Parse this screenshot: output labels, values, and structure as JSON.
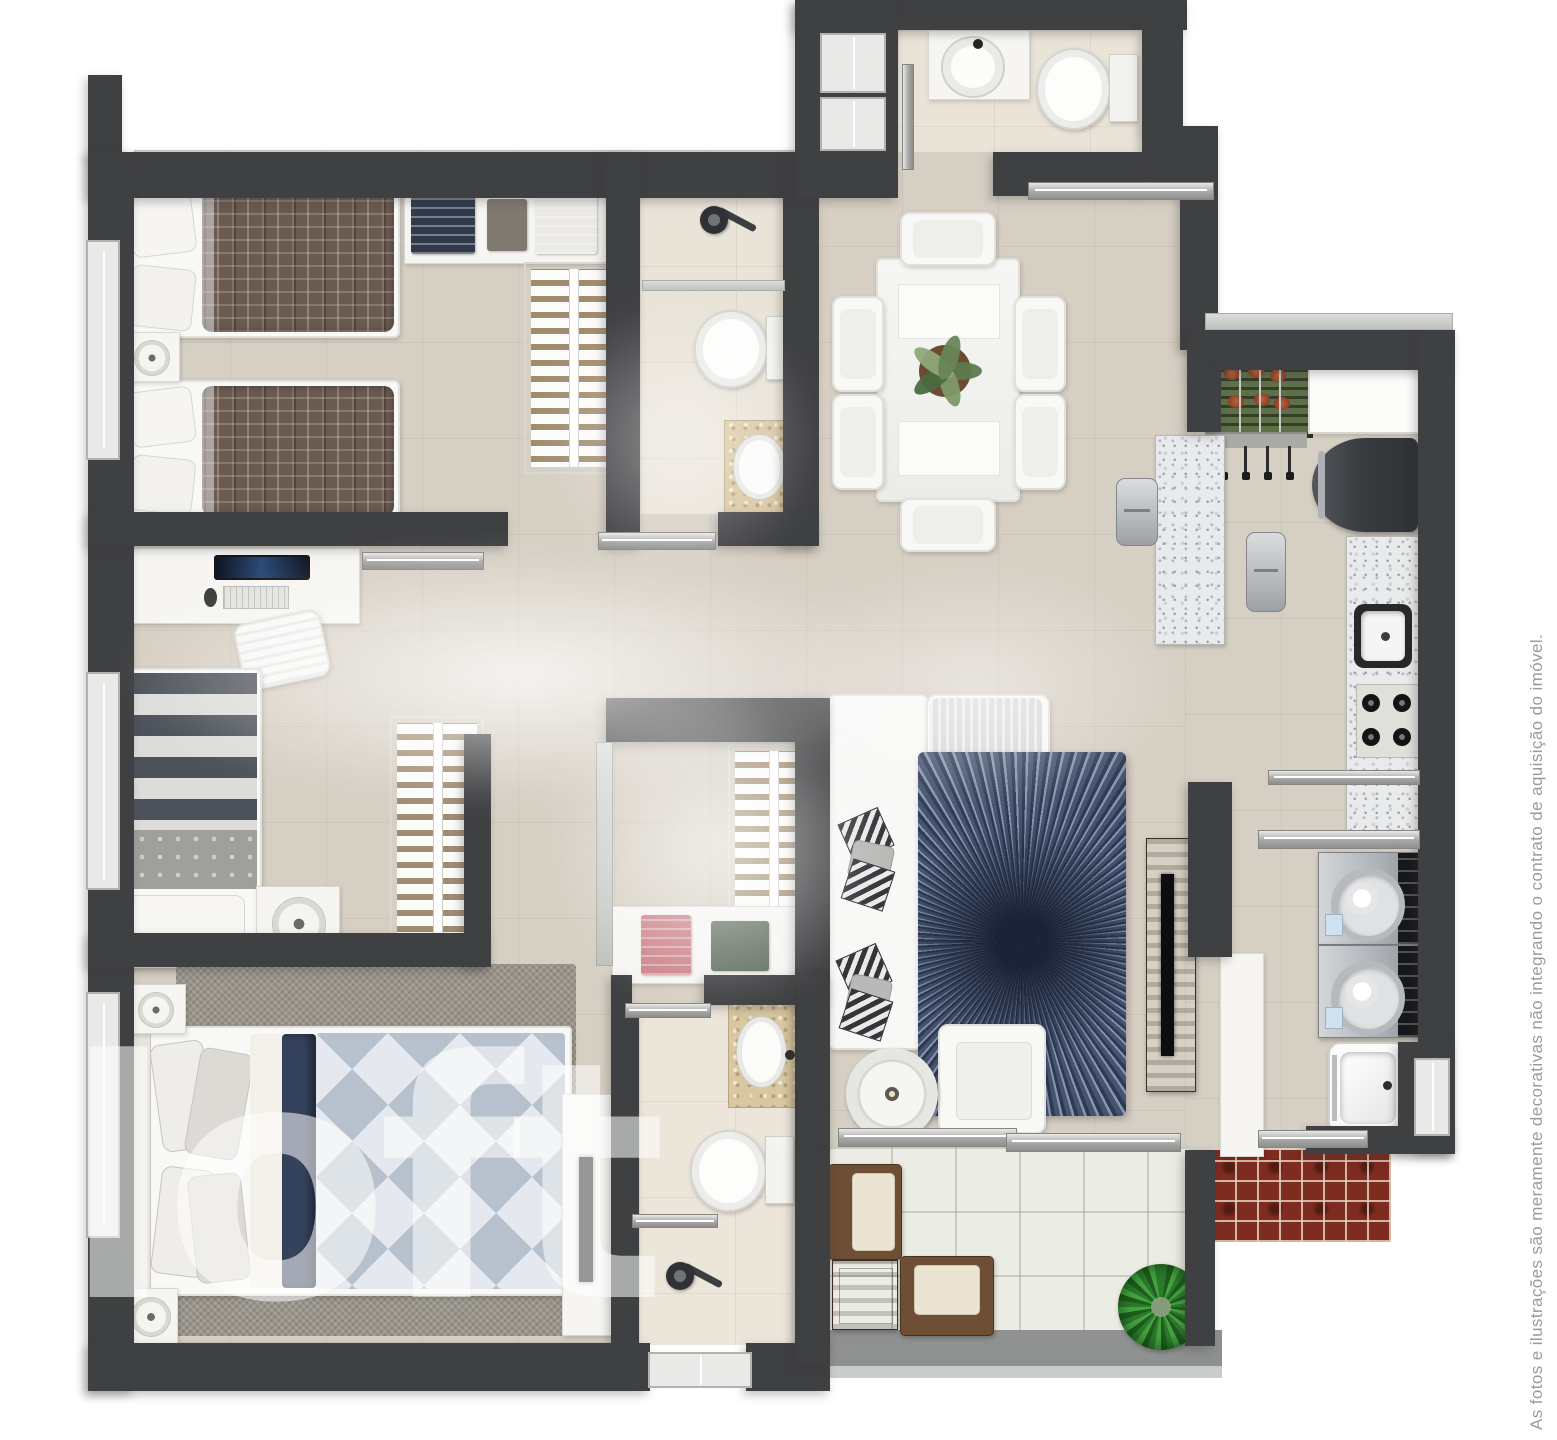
{
  "watermark": {
    "text": "loft"
  },
  "disclaimer": {
    "text": "As fotos e ilustrações são meramente decorativas não integrando o contrato de aquisição do imóvel."
  },
  "palette": {
    "wall": "#3f4042",
    "floor": "#d6cfc3",
    "bath_floor": "#e9e3d8",
    "balcony_tile": "#ebece3",
    "brick": "#7e2b20",
    "rug_blue": "#2e3a54",
    "rug_grey": "#9a958b",
    "plaid_brown": "#6a5a50",
    "navy_fold": "#35425c",
    "bbq_green": "#5e7048",
    "wood": "#6b4a33",
    "silver": "#a7a7a5",
    "granite": "#e9eaeb",
    "marble": "#d8c7a0",
    "watermark_white": "rgba(255,255,255,0.55)",
    "disclaimer_grey": "#9b9b9b"
  },
  "canvas": {
    "width": 1557,
    "height": 1440
  },
  "floorplan": {
    "floors": [
      {
        "name": "main-floor-left",
        "x": 134,
        "y": 150,
        "w": 1051,
        "h": 1000,
        "fill": "base"
      },
      {
        "name": "kitchen-laundry-floor",
        "x": 1185,
        "y": 330,
        "w": 233,
        "h": 822,
        "fill": "base"
      },
      {
        "name": "master-floor-strip",
        "x": 134,
        "y": 1150,
        "w": 661,
        "h": 195,
        "fill": "base"
      },
      {
        "name": "lavabo-floor",
        "x": 898,
        "y": 30,
        "w": 246,
        "h": 122,
        "fill": "cream"
      },
      {
        "name": "bathroom1-floor",
        "x": 640,
        "y": 170,
        "w": 143,
        "h": 344,
        "fill": "cream"
      },
      {
        "name": "master-bath-floor",
        "x": 639,
        "y": 1005,
        "w": 159,
        "h": 340,
        "fill": "cream2"
      },
      {
        "name": "balcony-floor",
        "x": 825,
        "y": 1145,
        "w": 362,
        "h": 190,
        "fill": "btile"
      },
      {
        "name": "service-brick-floor",
        "x": 1213,
        "y": 1150,
        "w": 178,
        "h": 92,
        "fill": "brick"
      },
      {
        "name": "balcony-railing",
        "x": 818,
        "y": 1330,
        "w": 404,
        "h": 36,
        "fill": "railband"
      },
      {
        "name": "balcony-railing-edge",
        "x": 818,
        "y": 1366,
        "w": 404,
        "h": 12,
        "fill": "railband-light"
      }
    ],
    "walls": [
      {
        "name": "corner-tab",
        "x": 88,
        "y": 75,
        "w": 34,
        "h": 82
      },
      {
        "name": "top-wall",
        "x": 88,
        "y": 152,
        "w": 710,
        "h": 46
      },
      {
        "name": "left-outer-wall",
        "x": 88,
        "y": 152,
        "w": 46,
        "h": 1239
      },
      {
        "name": "bedroom1-bottom-wall",
        "x": 88,
        "y": 512,
        "w": 420,
        "h": 34
      },
      {
        "name": "bedroom1-bath-wall",
        "x": 606,
        "y": 152,
        "w": 34,
        "h": 394
      },
      {
        "name": "bathroom1-right-wall",
        "x": 783,
        "y": 152,
        "w": 36,
        "h": 394
      },
      {
        "name": "bathroom1-bottom-wall",
        "x": 718,
        "y": 512,
        "w": 101,
        "h": 34
      },
      {
        "name": "lavabo-top-wall",
        "x": 795,
        "y": 0,
        "w": 392,
        "h": 30
      },
      {
        "name": "lavabo-left-block",
        "x": 795,
        "y": 0,
        "w": 103,
        "h": 198
      },
      {
        "name": "lavabo-right-wall",
        "x": 1142,
        "y": 28,
        "w": 41,
        "h": 102
      },
      {
        "name": "lavabo-corner-block",
        "x": 1142,
        "y": 126,
        "w": 76,
        "h": 70
      },
      {
        "name": "below-lavabo-wall",
        "x": 993,
        "y": 152,
        "w": 150,
        "h": 44
      },
      {
        "name": "dining-right-wall",
        "x": 1180,
        "y": 192,
        "w": 38,
        "h": 158
      },
      {
        "name": "kitchen-top-wall",
        "x": 1187,
        "y": 330,
        "w": 266,
        "h": 40
      },
      {
        "name": "bbq-left-wall",
        "x": 1187,
        "y": 368,
        "w": 34,
        "h": 64
      },
      {
        "name": "right-outer-wall",
        "x": 1418,
        "y": 330,
        "w": 37,
        "h": 822
      },
      {
        "name": "laundry-corner-block",
        "x": 1398,
        "y": 1042,
        "w": 57,
        "h": 110
      },
      {
        "name": "below-laundry-wall",
        "x": 1306,
        "y": 1126,
        "w": 149,
        "h": 28
      },
      {
        "name": "living-kitchen-wall",
        "x": 1188,
        "y": 782,
        "w": 44,
        "h": 175
      },
      {
        "name": "living-left-wall",
        "x": 795,
        "y": 698,
        "w": 35,
        "h": 452
      },
      {
        "name": "closet-top-wall",
        "x": 606,
        "y": 698,
        "w": 224,
        "h": 44
      },
      {
        "name": "bedroom2-right-wall",
        "x": 464,
        "y": 734,
        "w": 27,
        "h": 233
      },
      {
        "name": "bedroom2-bottom-wall",
        "x": 88,
        "y": 933,
        "w": 403,
        "h": 34
      },
      {
        "name": "closet-bottom-wall-left",
        "x": 611,
        "y": 975,
        "w": 21,
        "h": 30
      },
      {
        "name": "closet-bottom-wall-right",
        "x": 704,
        "y": 975,
        "w": 126,
        "h": 30
      },
      {
        "name": "master-bath-left-wall",
        "x": 611,
        "y": 1005,
        "w": 28,
        "h": 340
      },
      {
        "name": "master-bath-right-wall",
        "x": 798,
        "y": 975,
        "w": 32,
        "h": 372
      },
      {
        "name": "bottom-outer-wall-left",
        "x": 88,
        "y": 1343,
        "w": 562,
        "h": 48
      },
      {
        "name": "bottom-outer-wall-right",
        "x": 746,
        "y": 1343,
        "w": 84,
        "h": 48
      },
      {
        "name": "balcony-right-wall",
        "x": 1185,
        "y": 1150,
        "w": 30,
        "h": 196
      },
      {
        "name": "balcony-left-wall",
        "x": 795,
        "y": 1150,
        "w": 33,
        "h": 215
      }
    ],
    "windows": [
      {
        "name": "window-bedroom1",
        "x": 86,
        "y": 240,
        "w": 30,
        "h": 216
      },
      {
        "name": "window-bedroom2",
        "x": 86,
        "y": 672,
        "w": 30,
        "h": 214
      },
      {
        "name": "window-master",
        "x": 86,
        "y": 992,
        "w": 30,
        "h": 242
      },
      {
        "name": "window-lavabo-1",
        "x": 820,
        "y": 33,
        "w": 62,
        "h": 56
      },
      {
        "name": "window-lavabo-2",
        "x": 820,
        "y": 97,
        "w": 62,
        "h": 50
      },
      {
        "name": "window-laundry",
        "x": 1414,
        "y": 1058,
        "w": 32,
        "h": 74
      },
      {
        "name": "window-master-bath",
        "x": 648,
        "y": 1352,
        "w": 100,
        "h": 32
      }
    ],
    "rails": [
      {
        "name": "dining-partition-rail",
        "x": 1028,
        "y": 182,
        "w": 184,
        "h": 16
      },
      {
        "name": "bedroom2-door-rail",
        "x": 362,
        "y": 552,
        "w": 120,
        "h": 16
      },
      {
        "name": "bathroom1-door-rail",
        "x": 598,
        "y": 532,
        "w": 116,
        "h": 16
      },
      {
        "name": "kitchen-laundry-rail",
        "x": 1268,
        "y": 770,
        "w": 150,
        "h": 13
      },
      {
        "name": "laundry-shelf-rail",
        "x": 1258,
        "y": 830,
        "w": 160,
        "h": 17
      },
      {
        "name": "balcony-door-rail-1",
        "x": 838,
        "y": 1128,
        "w": 177,
        "h": 17
      },
      {
        "name": "balcony-door-rail-2",
        "x": 1006,
        "y": 1133,
        "w": 173,
        "h": 17
      },
      {
        "name": "service-window-rail",
        "x": 1258,
        "y": 1130,
        "w": 108,
        "h": 16
      },
      {
        "name": "master-bath-door-rail",
        "x": 625,
        "y": 1003,
        "w": 84,
        "h": 13
      },
      {
        "name": "master-bath-shelf-rail",
        "x": 632,
        "y": 1214,
        "w": 84,
        "h": 12
      },
      {
        "name": "bathroom1-glass",
        "x": 642,
        "y": 280,
        "w": 141,
        "h": 9,
        "glass": true
      },
      {
        "name": "lavabo-shower-rail",
        "x": 902,
        "y": 64,
        "w": 10,
        "h": 104,
        "vertical": true
      },
      {
        "name": "bbq-window-rail",
        "x": 1205,
        "y": 313,
        "w": 246,
        "h": 15,
        "glass": true
      },
      {
        "name": "closet-glass-partition",
        "x": 596,
        "y": 742,
        "w": 15,
        "h": 222,
        "vertical": true,
        "glass": true
      }
    ],
    "furniture": [
      {
        "type": "shelfUnit",
        "name": "wardrobe-top-shelf",
        "x": 404,
        "y": 186,
        "w": 204,
        "h": 76,
        "items": [
          {
            "x": 6,
            "y": 7,
            "w": 64,
            "h": 60,
            "color": "#303a4a",
            "lines": true
          },
          {
            "x": 82,
            "y": 12,
            "w": 40,
            "h": 52,
            "color": "#80796f"
          },
          {
            "x": 130,
            "y": 7,
            "w": 62,
            "h": 60,
            "color": "#eceae6",
            "lines": true
          }
        ]
      },
      {
        "type": "rack",
        "name": "bedroom1-closet-rack",
        "x": 524,
        "y": 262,
        "w": 84,
        "h": 198
      },
      {
        "type": "twinBed",
        "name": "twin-bed-1",
        "x": 116,
        "y": 184,
        "w": 280,
        "h": 150
      },
      {
        "type": "twinBed",
        "name": "twin-bed-2",
        "x": 116,
        "y": 380,
        "w": 280,
        "h": 138
      },
      {
        "type": "nightstand",
        "name": "bedroom1-nightstand",
        "x": 122,
        "y": 332,
        "w": 56,
        "h": 48
      },
      {
        "type": "desk",
        "name": "bedroom2-desk",
        "x": 116,
        "y": 548,
        "w": 242,
        "h": 74
      },
      {
        "type": "deskChair",
        "name": "bedroom2-desk-chair",
        "x": 238,
        "y": 616,
        "w": 84,
        "h": 64,
        "rot": -12
      },
      {
        "type": "stripeBed",
        "name": "single-bed",
        "x": 110,
        "y": 668,
        "w": 148,
        "h": 296
      },
      {
        "type": "nightstand",
        "name": "bedroom2-nightstand",
        "x": 256,
        "y": 886,
        "w": 82,
        "h": 72
      },
      {
        "type": "rack",
        "name": "bedroom2-closet-rack",
        "x": 390,
        "y": 716,
        "w": 80,
        "h": 220
      },
      {
        "type": "showerHead",
        "name": "bathroom1-shower",
        "x": 698,
        "y": 202,
        "w": 56,
        "h": 44
      },
      {
        "type": "toilet",
        "name": "bathroom1-toilet",
        "x": 694,
        "y": 310,
        "w": 100,
        "h": 74
      },
      {
        "type": "vanity",
        "name": "bathroom1-sink",
        "x": 724,
        "y": 420,
        "w": 76,
        "h": 96
      },
      {
        "type": "roundSink",
        "name": "lavabo-sink",
        "x": 928,
        "y": 30,
        "w": 100,
        "h": 68
      },
      {
        "type": "toilet",
        "name": "lavabo-toilet",
        "x": 1036,
        "y": 48,
        "w": 102,
        "h": 78
      },
      {
        "type": "table",
        "name": "dining-table",
        "x": 876,
        "y": 258,
        "w": 140,
        "h": 240
      },
      {
        "type": "chair",
        "name": "dining-chair-top",
        "x": 900,
        "y": 212,
        "w": 92,
        "h": 50
      },
      {
        "type": "chair",
        "name": "dining-chair-bottom",
        "x": 900,
        "y": 498,
        "w": 92,
        "h": 50
      },
      {
        "type": "chair",
        "name": "dining-chair-left-1",
        "x": 832,
        "y": 296,
        "w": 48,
        "h": 92
      },
      {
        "type": "chair",
        "name": "dining-chair-left-2",
        "x": 832,
        "y": 394,
        "w": 48,
        "h": 92
      },
      {
        "type": "chair",
        "name": "dining-chair-right-1",
        "x": 1014,
        "y": 296,
        "w": 48,
        "h": 92
      },
      {
        "type": "chair",
        "name": "dining-chair-right-2",
        "x": 1014,
        "y": 394,
        "w": 48,
        "h": 92
      },
      {
        "type": "plantPot",
        "name": "dining-centerpiece-plant",
        "x": 914,
        "y": 340,
        "w": 62,
        "h": 62
      },
      {
        "type": "bbq",
        "name": "barbecue-grill",
        "x": 1205,
        "y": 348,
        "w": 102,
        "h": 84
      },
      {
        "type": "counterEdge",
        "name": "bbq-counter-edge",
        "x": 1205,
        "y": 432,
        "w": 102,
        "h": 14
      },
      {
        "type": "utensils",
        "name": "bbq-skewer-utensils",
        "x": 1222,
        "y": 446,
        "w": 74,
        "h": 34
      },
      {
        "type": "whiteCounter",
        "name": "bbq-side-counter",
        "x": 1308,
        "y": 350,
        "w": 110,
        "h": 80
      },
      {
        "type": "fridge",
        "name": "refrigerator",
        "x": 1312,
        "y": 438,
        "w": 106,
        "h": 94
      },
      {
        "type": "granitePiece",
        "name": "kitchen-island",
        "x": 1155,
        "y": 435,
        "w": 68,
        "h": 208
      },
      {
        "type": "stool",
        "name": "island-stool-1",
        "x": 1116,
        "y": 478,
        "w": 40,
        "h": 66
      },
      {
        "type": "stool",
        "name": "island-stool-2",
        "x": 1246,
        "y": 532,
        "w": 38,
        "h": 78
      },
      {
        "type": "granitePiece",
        "name": "kitchen-counter",
        "x": 1346,
        "y": 536,
        "w": 72,
        "h": 298
      },
      {
        "type": "squareSink",
        "name": "kitchen-sink",
        "x": 1354,
        "y": 604,
        "w": 58,
        "h": 64
      },
      {
        "type": "cooktop",
        "name": "cooktop",
        "x": 1356,
        "y": 684,
        "w": 62,
        "h": 72
      },
      {
        "type": "washer",
        "name": "washing-machine-1",
        "x": 1318,
        "y": 852,
        "w": 100,
        "h": 91
      },
      {
        "type": "washer",
        "name": "washing-machine-2",
        "x": 1318,
        "y": 945,
        "w": 100,
        "h": 91
      },
      {
        "type": "tub",
        "name": "laundry-tub",
        "x": 1328,
        "y": 1042,
        "w": 74,
        "h": 88
      },
      {
        "type": "cabinet",
        "name": "laundry-cabinet",
        "x": 1220,
        "y": 953,
        "w": 42,
        "h": 202
      },
      {
        "type": "console",
        "name": "tv-console",
        "x": 1146,
        "y": 838,
        "w": 48,
        "h": 252
      },
      {
        "type": "softRect",
        "name": "sofa-base",
        "x": 826,
        "y": 694,
        "w": 100,
        "h": 352
      },
      {
        "type": "softRect",
        "name": "sofa-chaise",
        "x": 926,
        "y": 694,
        "w": 120,
        "h": 110
      },
      {
        "type": "throw",
        "name": "sofa-throw-blanket",
        "x": 930,
        "y": 698,
        "w": 112,
        "h": 82
      },
      {
        "type": "pillows",
        "name": "sofa-pillows-1",
        "x": 840,
        "y": 812,
        "w": 60,
        "h": 96
      },
      {
        "type": "pillows",
        "name": "sofa-pillows-2",
        "x": 838,
        "y": 948,
        "w": 58,
        "h": 90
      },
      {
        "type": "sunburstRug",
        "name": "living-room-rug",
        "x": 918,
        "y": 752,
        "w": 208,
        "h": 364
      },
      {
        "type": "armchair",
        "name": "living-armchair",
        "x": 938,
        "y": 1024,
        "w": 104,
        "h": 106
      },
      {
        "type": "roundTable",
        "name": "living-side-table",
        "x": 846,
        "y": 1048,
        "w": 70,
        "h": 70
      },
      {
        "type": "rack",
        "name": "master-closet-rack",
        "x": 728,
        "y": 744,
        "w": 76,
        "h": 172
      },
      {
        "type": "shelfUnit",
        "name": "master-closet-shelf",
        "x": 612,
        "y": 906,
        "w": 192,
        "h": 76,
        "items": [
          {
            "x": 28,
            "y": 8,
            "w": 50,
            "h": 60,
            "color": "#c98086",
            "lines": true
          },
          {
            "x": 98,
            "y": 14,
            "w": 58,
            "h": 50,
            "color": "#5f6d5e"
          }
        ]
      },
      {
        "type": "vanity",
        "name": "master-bath-sink",
        "x": 728,
        "y": 1000,
        "w": 72,
        "h": 106
      },
      {
        "type": "toilet",
        "name": "master-bath-toilet",
        "x": 690,
        "y": 1130,
        "w": 104,
        "h": 78
      },
      {
        "type": "showerHead",
        "name": "master-bath-shower",
        "x": 664,
        "y": 1258,
        "w": 60,
        "h": 48
      },
      {
        "type": "shagRug",
        "name": "master-bedroom-rug",
        "x": 176,
        "y": 964,
        "w": 400,
        "h": 372
      },
      {
        "type": "masterBed",
        "name": "master-bed",
        "x": 128,
        "y": 1026,
        "w": 440,
        "h": 266
      },
      {
        "type": "nightstand",
        "name": "master-nightstand-1",
        "x": 124,
        "y": 984,
        "w": 60,
        "h": 48
      },
      {
        "type": "nightstand",
        "name": "master-nightstand-2",
        "x": 122,
        "y": 1288,
        "w": 54,
        "h": 54
      },
      {
        "type": "dresser",
        "name": "master-dresser-tv",
        "x": 562,
        "y": 1094,
        "w": 52,
        "h": 240
      },
      {
        "type": "patioChairR",
        "name": "balcony-chair-1",
        "x": 828,
        "y": 1164,
        "w": 72,
        "h": 94
      },
      {
        "type": "woodTable",
        "name": "balcony-table",
        "x": 832,
        "y": 1260,
        "w": 64,
        "h": 68
      },
      {
        "type": "patioChairU",
        "name": "balcony-chair-2",
        "x": 900,
        "y": 1256,
        "w": 92,
        "h": 78
      },
      {
        "type": "spikyPlant",
        "name": "balcony-plant",
        "x": 1118,
        "y": 1264,
        "w": 86,
        "h": 86
      }
    ],
    "fog": [
      {
        "name": "haze-1",
        "x": 120,
        "y": 545,
        "w": 800,
        "h": 260,
        "o": 0.9
      },
      {
        "name": "haze-2",
        "x": 545,
        "y": 680,
        "w": 340,
        "h": 330,
        "o": 0.75
      },
      {
        "name": "haze-3",
        "x": 540,
        "y": 300,
        "w": 280,
        "h": 280,
        "o": 0.5
      },
      {
        "name": "haze-4",
        "x": 760,
        "y": 560,
        "w": 430,
        "h": 250,
        "o": 0.55
      }
    ]
  }
}
